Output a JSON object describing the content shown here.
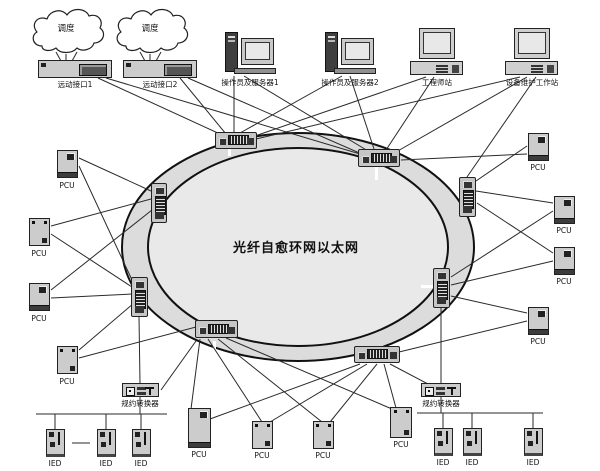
{
  "title": "光纤自愈环网以太网",
  "clouds": [
    {
      "label": "调度"
    },
    {
      "label": "调度"
    }
  ],
  "top_devices": [
    {
      "label": "远动接口1"
    },
    {
      "label": "远动接口2"
    },
    {
      "label": "操作员及服务器1"
    },
    {
      "label": "操作员及服务器2"
    },
    {
      "label": "工程师站"
    },
    {
      "label": "设备维护工作站"
    }
  ],
  "labels": {
    "pcu": "PCU",
    "ied": "IED",
    "converter": "规约转换器"
  },
  "colors": {
    "line": "#2a2a2a",
    "ring_band_fill": "#dcdcdc",
    "ring_inner_fill": "#e9e9e9",
    "device_fill": "#cccccc",
    "stroke": "#111111"
  }
}
